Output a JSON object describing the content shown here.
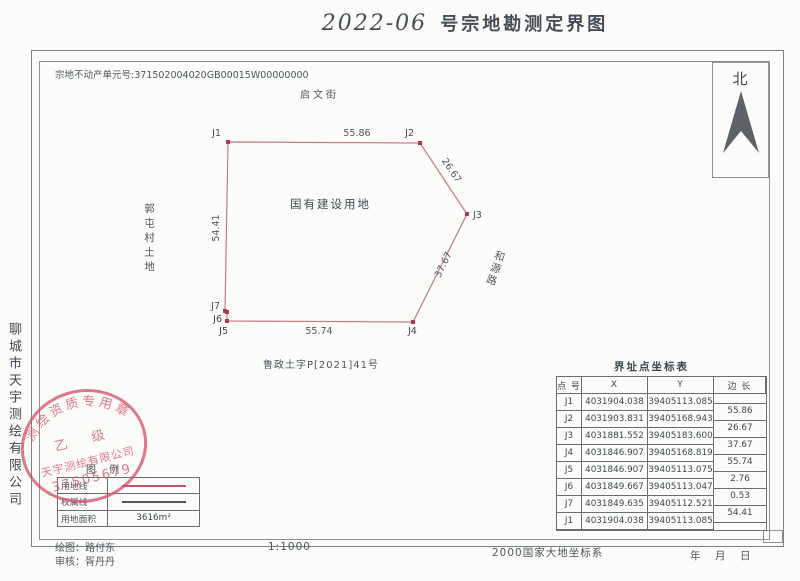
{
  "page": {
    "title_hand": "2022-06",
    "title_main": "号宗地勘测定界图"
  },
  "header": {
    "parcel_no": "宗地不动产单元号:371502004020GB00015W00000000"
  },
  "north": {
    "label": "北"
  },
  "map": {
    "street": "启文街",
    "west_land": "郭屯村土地",
    "east_road": "和源路",
    "center_label": "国有建设用地",
    "doc_no": "鲁政土字P[2021]41号",
    "vertices": [
      {
        "name": "J1",
        "x": 228,
        "y": 142,
        "lx": 221,
        "ly": 136,
        "anchor": "end"
      },
      {
        "name": "J2",
        "x": 420,
        "y": 143,
        "lx": 414,
        "ly": 136,
        "anchor": "end"
      },
      {
        "name": "J3",
        "x": 467,
        "y": 214,
        "lx": 473,
        "ly": 218,
        "anchor": "start"
      },
      {
        "name": "J4",
        "x": 413,
        "y": 322,
        "lx": 408,
        "ly": 334,
        "anchor": "start"
      },
      {
        "name": "J5",
        "x": 227,
        "y": 321,
        "lx": 228,
        "ly": 334,
        "anchor": "end"
      },
      {
        "name": "J6",
        "x": 227,
        "y": 312,
        "lx": 222,
        "ly": 322,
        "anchor": "end"
      },
      {
        "name": "J7",
        "x": 225,
        "y": 311,
        "lx": 220,
        "ly": 309,
        "anchor": "end"
      }
    ],
    "edge_labels": [
      {
        "text": "55.86",
        "x": 357,
        "y": 136,
        "rot": 0
      },
      {
        "text": "26.67",
        "x": 449,
        "y": 172,
        "rot": 56
      },
      {
        "text": "37.67",
        "x": 446,
        "y": 266,
        "rot": -64
      },
      {
        "text": "55.74",
        "x": 319,
        "y": 334,
        "rot": 0
      },
      {
        "text": "54.41",
        "x": 219,
        "y": 228,
        "rot": -90
      }
    ]
  },
  "coord_table": {
    "title": "界址点坐标表",
    "headers": [
      "点 号",
      "X",
      "Y",
      "边 长"
    ],
    "rows": [
      [
        "J1",
        "4031904.038",
        "39405113.085"
      ],
      [
        "J2",
        "4031903.831",
        "39405168.943"
      ],
      [
        "J3",
        "4031881.552",
        "39405183.600"
      ],
      [
        "J4",
        "4031846.907",
        "39405168.819"
      ],
      [
        "J5",
        "4031846.907",
        "39405113.075"
      ],
      [
        "J6",
        "4031849.667",
        "39405113.047"
      ],
      [
        "J7",
        "4031849.635",
        "39405112.521"
      ],
      [
        "J1",
        "4031904.038",
        "39405113.085"
      ]
    ],
    "side_lengths": [
      "55.86",
      "26.67",
      "37.67",
      "55.74",
      "2.76",
      "0.53",
      "54.41"
    ]
  },
  "legend": {
    "title": "图 例",
    "line_rows": [
      {
        "label": "用地线",
        "color": "#c2556a"
      },
      {
        "label": "权属线",
        "color": "#555a5e"
      }
    ],
    "area_label": "用地面积",
    "area_value": "3616m²"
  },
  "stamp": {
    "arc": "测绘资质专用章",
    "grade": "乙　级",
    "company": "天宇测绘有限公司",
    "number": "37505679"
  },
  "side_company": "聊城市天宇测绘有限公司",
  "footer": {
    "draw_label": "绘图：",
    "draw_name": "路付东",
    "check_label": "审核：",
    "check_name": "胥丹丹",
    "scale": "1:1000",
    "datum": "2000国家大地坐标系",
    "date": "年　月　日"
  },
  "colors": {
    "ink": "#4d565e",
    "parcel_line": "#c87884",
    "stamp_red": "#d4556b"
  }
}
